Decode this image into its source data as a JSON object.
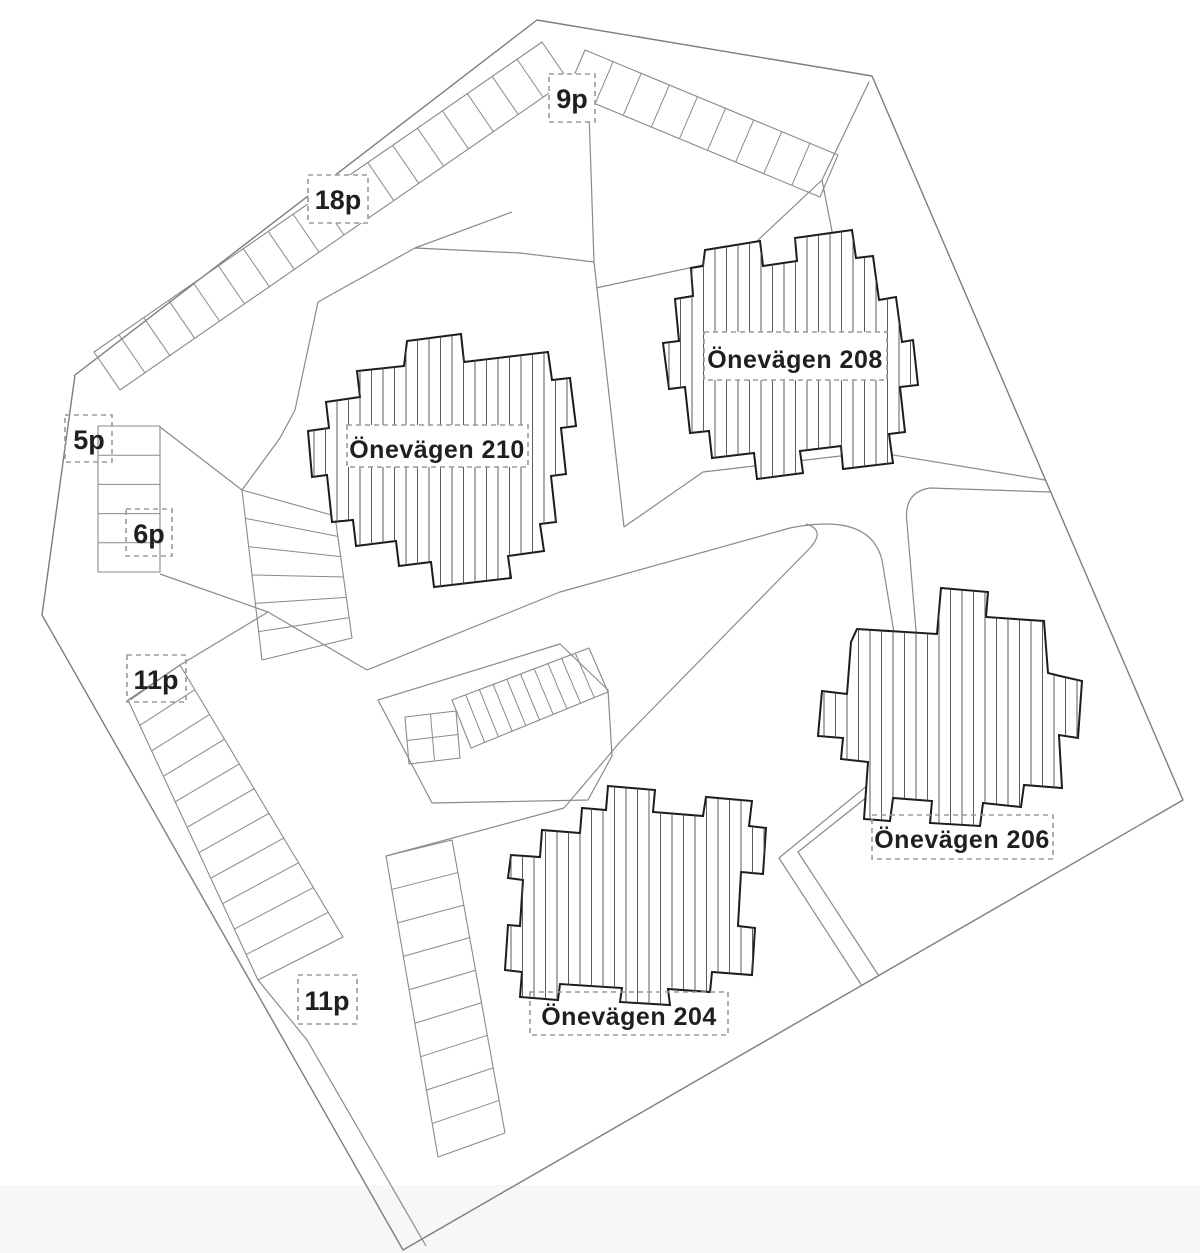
{
  "plan": {
    "type": "site-plan",
    "buildings": [
      {
        "id": "210",
        "name": "Önevägen 210"
      },
      {
        "id": "208",
        "name": "Önevägen 208"
      },
      {
        "id": "206",
        "name": "Önevägen 206"
      },
      {
        "id": "204",
        "name": "Önevägen 204"
      }
    ],
    "parking": [
      {
        "id": "9p",
        "label": "9p",
        "stalls": 9
      },
      {
        "id": "18p",
        "label": "18p",
        "stalls": 18
      },
      {
        "id": "5p",
        "label": "5p",
        "stalls": 5
      },
      {
        "id": "6p",
        "label": "6p",
        "stalls": 6
      },
      {
        "id": "11p-west",
        "label": "11p",
        "stalls": 11
      },
      {
        "id": "11p-south",
        "label": "11p",
        "stalls": 11
      }
    ],
    "colors": {
      "background": "#ffffff",
      "boundary_line": "#7d7d7d",
      "road_line": "#8a8a8a",
      "building_outline": "#1c1c1c",
      "hatch_line": "#4a4a4a",
      "dashed_box": "#9a9a9a",
      "label_text": "#1f1f1f"
    }
  }
}
